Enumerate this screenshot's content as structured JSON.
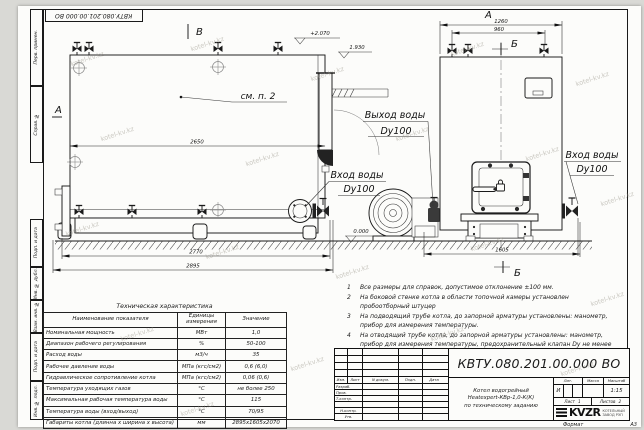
{
  "watermark": {
    "text": "kotel-kv.kz"
  },
  "stamp_top": {
    "doc_number": "КВТУ.080.201.00.000  ВО"
  },
  "margin": {
    "labels": [
      "Перв. примен.",
      "Справ. №",
      "Подп. и дата",
      "Инв. № дубл.",
      "Взам. инв. №",
      "Подп. и дата",
      "Инв. № подл."
    ]
  },
  "drawing": {
    "section_b_top": "В",
    "section_a_side": "А",
    "view_a_label": "А",
    "section_b_front_top": "Б",
    "section_b_front_bottom": "Б",
    "see_note": "см. п. 2",
    "elev_plus2070": "+2.070",
    "elev_1930": "1.930",
    "elev_0000": "0.000",
    "label_water_out": "Выход воды",
    "label_water_out_dn": "Dy100",
    "label_water_in_side": "Вход воды",
    "label_water_in_side_dn": "Dy100",
    "label_water_in_front": "Вход воды",
    "label_water_in_front_dn": "Dy100",
    "dim_2650": "2650",
    "dim_2770": "2770",
    "dim_2895": "2895",
    "dim_1260": "1260",
    "dim_960": "960",
    "dim_1605": "1605"
  },
  "notes": {
    "items": [
      {
        "num": "1",
        "text": "Все размеры для справок, допустимое отклонение  ±100 мм."
      },
      {
        "num": "2",
        "text": "На боковой стенке котла в области топочной камеры установлен пробоотборный штуцер"
      },
      {
        "num": "3",
        "text": "На  подводящий трубе котла, до запорной арматуры установлены: манометр, прибор для измерения температуры."
      },
      {
        "num": "4",
        "text": "На отводящий трубе котла, до запорной арматуры установлены: манометр, прибор для измерения температуры, предохранительный клапан Dу не менее 50 мм и отвод с обратным клапаном Dу не менее 50 мм."
      }
    ]
  },
  "spec_table": {
    "title": "Техническая характеристика",
    "headers": [
      "Наименование показателя",
      "Единицы измерения",
      "Значение"
    ],
    "rows": [
      [
        "Номинальная мощность",
        "МВт",
        "1,0"
      ],
      [
        "Диапазон рабочего регулирования",
        "%",
        "50-100"
      ],
      [
        "Расход воды",
        "м3/ч",
        "35"
      ],
      [
        "Рабочее давление воды",
        "МПа (кгс/см2)",
        "0,6 (6,0)"
      ],
      [
        "Гидравлическое сопротивление котла",
        "МПа (кгс/см2)",
        "0,06 (0,6)"
      ],
      [
        "Температура уходящих газов",
        "°С",
        "не более 250"
      ],
      [
        "Максимальная рабочая температура воды",
        "°С",
        "115"
      ],
      [
        "Температура воды (вход/выход)",
        "°С",
        "70/95"
      ],
      [
        "Габариты котла (длинна х ширина х высота)",
        "мм",
        "2895х1605х2070"
      ]
    ]
  },
  "title_block": {
    "doc_number": "КВТУ.080.201.00.000  ВО",
    "product_lines": [
      "Котел водогрейный",
      "Heatexpert-КВр-1,0-К(К)",
      "по техническому заданию"
    ],
    "rev_headers": [
      "Изм.",
      "Лист",
      "N докум.",
      "Подп.",
      "Дата"
    ],
    "roles": [
      "Разраб.",
      "Пров.",
      "Т.контр.",
      " ",
      "Н.контр.",
      "Утв."
    ],
    "lit_header": "Лит.",
    "mass_header": "Масса",
    "scale_header": "Масштаб",
    "lit_value": "И",
    "scale_value": "1:15",
    "sheet_label": "Лист",
    "sheet_value": "1",
    "sheets_label": "Листов",
    "sheets_value": "2",
    "logo_text": "KVZR",
    "company_line1": "КОТЕЛЬНЫЙ",
    "company_line2": "ЗАВОД РЭП",
    "format_label": "Формат",
    "format_value": "А3"
  }
}
